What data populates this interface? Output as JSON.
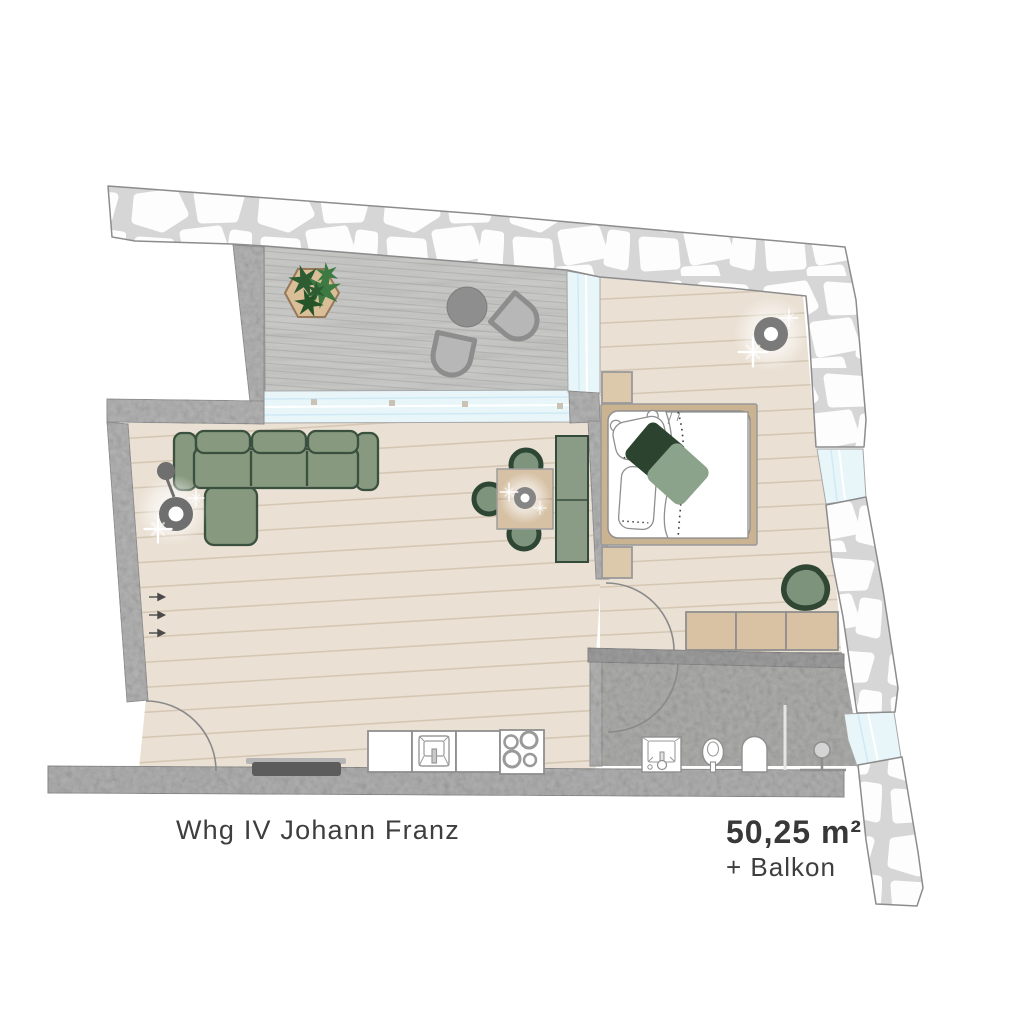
{
  "labels": {
    "apartment": "Whg IV Johann Franz",
    "area": "50,25 m²",
    "area_extra": "+ Balkon"
  },
  "palette": {
    "background": "#ffffff",
    "stone_mortar": "#d6d6d6",
    "stone_fill": "#fdfdfd",
    "concrete_wall": "#b4b4b4",
    "wood_floor": "#eae0d3",
    "plank_line": "#d5c7b4",
    "balcony_deck": "#cbcbc9",
    "window_glass": "#e8f6fa",
    "sofa_green": "#87997f",
    "sofa_outline": "#3a513f",
    "pillow_dark_green": "#2c432f",
    "pillow_sage": "#8ba28b",
    "wood_furniture": "#d6c1a5",
    "bathroom_floor": "#adadab",
    "text_color": "#3e3e3e"
  },
  "elements": {
    "rooms": [
      "balcony",
      "living-room",
      "bedroom",
      "bathroom",
      "kitchen-line"
    ],
    "furniture": [
      "planter",
      "balcony-table",
      "balcony-chairs",
      "corner-sofa",
      "floor-lamp",
      "dining-table",
      "dining-chairs",
      "pendant-lamp",
      "wardrobe",
      "tv-sideboard",
      "kitchen-cabinets",
      "kitchen-sink",
      "stove",
      "double-bed",
      "nightstands",
      "ceiling-lamp",
      "dresser",
      "lounge-chair",
      "bath-sink",
      "toilet",
      "shower-niche",
      "shower-valve"
    ]
  }
}
